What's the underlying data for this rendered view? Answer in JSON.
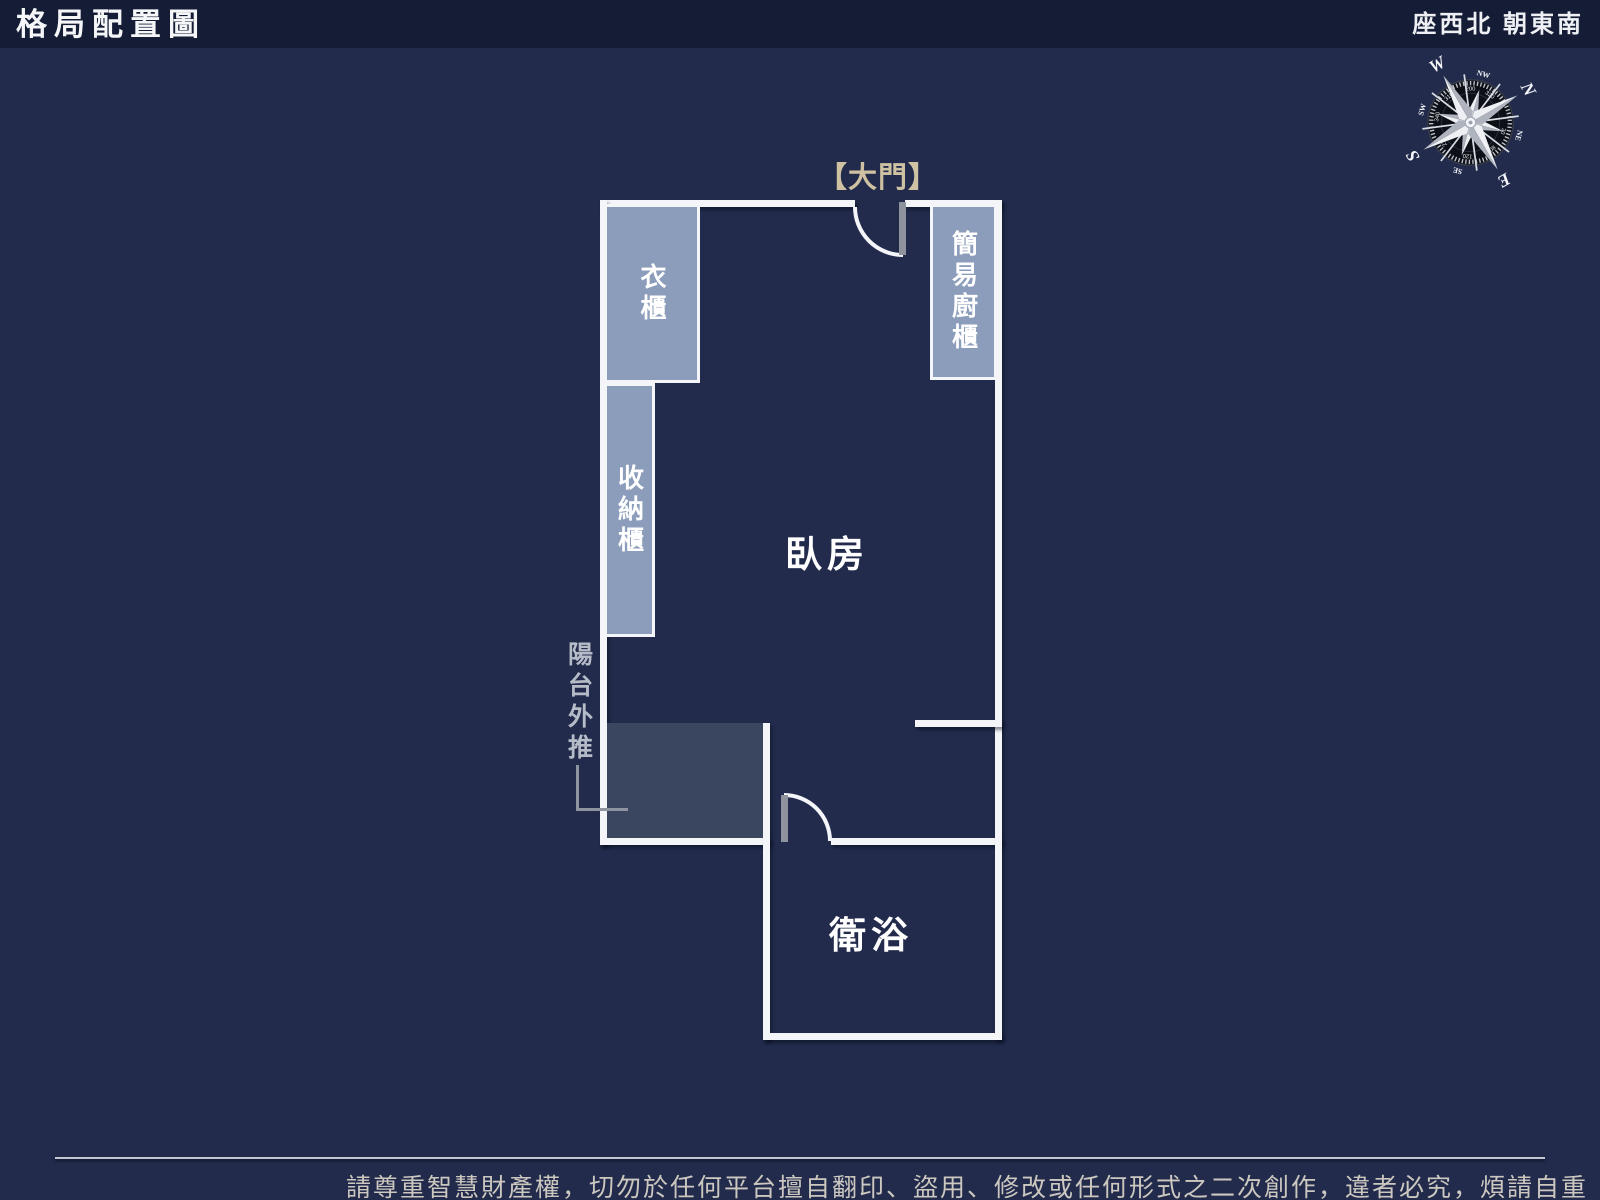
{
  "header": {
    "title": "格局配置圖",
    "orientation": "座西北 朝東南"
  },
  "plan": {
    "entrance_label": "【大門】",
    "bedroom_label": "臥房",
    "bathroom_label": "衛浴",
    "wardrobe_label": "衣櫃",
    "storage_label": "收納櫃",
    "kitchen_label": "簡易廚櫃",
    "balcony_label": "陽台外推"
  },
  "compass": {
    "n": "N",
    "e": "E",
    "s": "S",
    "w": "W",
    "nw": "NW",
    "ne": "NE",
    "se": "SE",
    "sw": "SW",
    "degrees": [
      "200",
      "320",
      "30",
      "80",
      "120",
      "210",
      "340",
      "310"
    ],
    "rotation_deg": 60
  },
  "footer": {
    "disclaimer": "請尊重智慧財產權，切勿於任何平台擅自翻印、盜用、修改或任何形式之二次創作，違者必究，煩請自重"
  },
  "colors": {
    "background": "#222b4c",
    "header_bar": "#141c36",
    "wall": "#f3f5f8",
    "cabinet_fill": "#8c9dbb",
    "balcony_fill": "#3a4560",
    "door_panel": "#8e939d",
    "entrance_accent": "#cfc2a2"
  }
}
